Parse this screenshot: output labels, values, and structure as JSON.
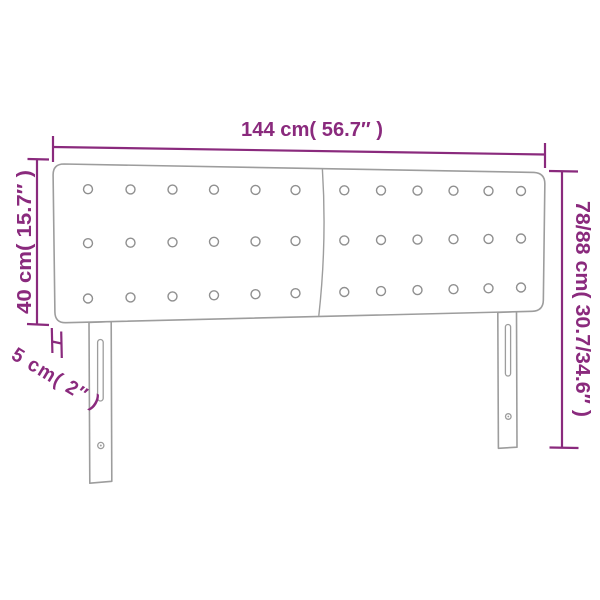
{
  "style": {
    "dimension_color": "#8a2a7d",
    "outline_color": "#9d9d9d",
    "button_outline_color": "#8f8f8f",
    "background_color": "#ffffff"
  },
  "dimensions": {
    "width": {
      "label": "144 cm( 56.7″ )",
      "cm": "144",
      "inches": "56.7"
    },
    "total_height": {
      "label": "78/88 cm( 30.7/34.6″ )",
      "cm": "78/88",
      "inches": "30.7/34.6"
    },
    "headboard_height": {
      "label": "40 cm( 15.7″ )",
      "cm": "40",
      "inches": "15.7"
    },
    "depth": {
      "label": "5 cm( 2″ )",
      "cm": "5",
      "inches": "2"
    }
  },
  "headboard": {
    "panels": 2,
    "button_rows": 3,
    "button_columns_per_panel": 6,
    "legs": 2
  }
}
